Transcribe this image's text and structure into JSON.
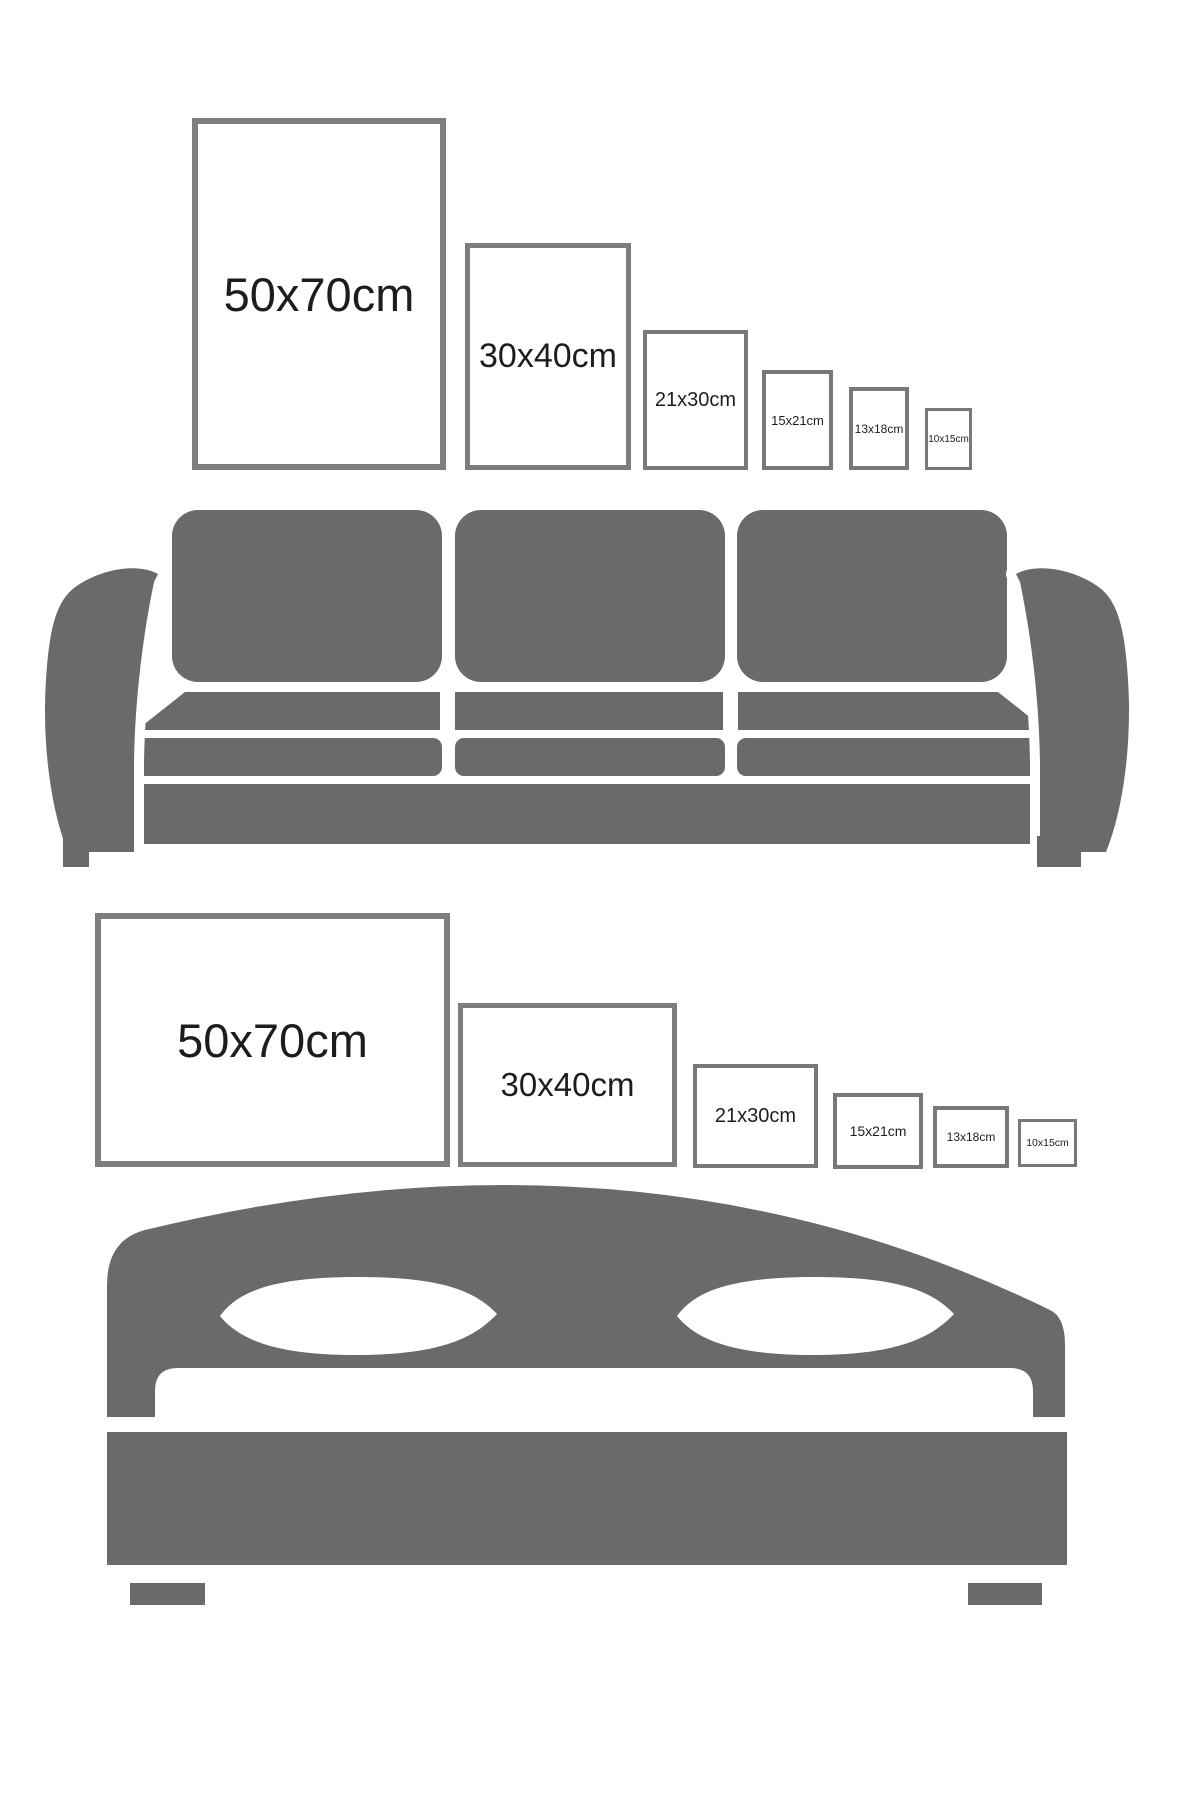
{
  "colors": {
    "furniture_gray": "#6a6a6c",
    "frame_border_large": "#7d7e80",
    "frame_border_small": "#77787a",
    "label_text": "#1d1d1b",
    "background": "#ffffff"
  },
  "sections": [
    {
      "id": "living-room",
      "furniture": "sofa",
      "orientation": "portrait",
      "frames": [
        {
          "label": "50x70cm"
        },
        {
          "label": "30x40cm"
        },
        {
          "label": "21x30cm"
        },
        {
          "label": "15x21cm"
        },
        {
          "label": "13x18cm"
        },
        {
          "label": "10x15cm"
        }
      ]
    },
    {
      "id": "bedroom",
      "furniture": "bed",
      "orientation": "landscape",
      "frames": [
        {
          "label": "50x70cm"
        },
        {
          "label": "30x40cm"
        },
        {
          "label": "21x30cm"
        },
        {
          "label": "15x21cm"
        },
        {
          "label": "13x18cm"
        },
        {
          "label": "10x15cm"
        }
      ]
    }
  ]
}
